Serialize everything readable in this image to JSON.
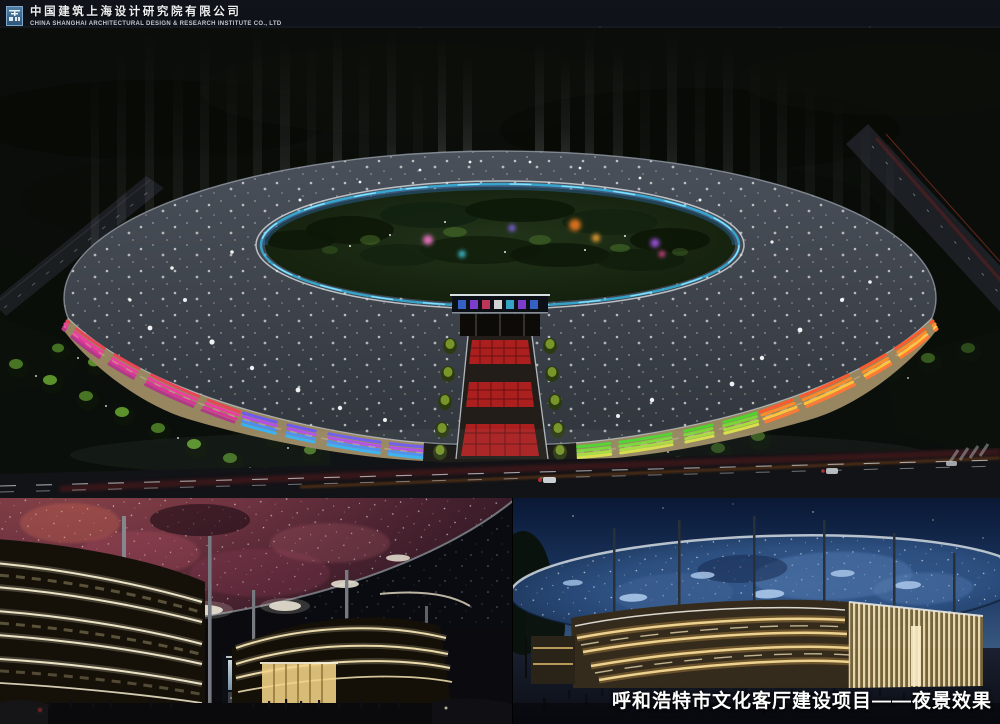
{
  "header": {
    "company_name_zh": "中国建筑上海设计研究院有限公司",
    "company_name_en": "CHINA SHANGHAI ARCHITECTURAL DESIGN & RESEARCH INSTITUTE CO., LTD"
  },
  "footer": {
    "caption": "呼和浩特市文化客厅建设项目——夜景效果"
  },
  "palette": {
    "night_sky": "#0b0e13",
    "deep_blue_sky": "#16325c",
    "roof_gray": "#3e434b",
    "facade_tan": "#97865f",
    "facade_red": "#ea4556",
    "facade_magenta": "#ee3fa0",
    "facade_purple": "#b44fe8",
    "facade_blue": "#38b2f2",
    "facade_green": "#4fd42e",
    "facade_yellow": "#ffc23a",
    "facade_orange": "#ff8c2a",
    "glass_ring_cyan": "#35b9e6",
    "pavement_red": "#b32020",
    "nebula_canopy_red": "#6e3340",
    "starry_canopy_blue": "#2c4f80",
    "band_gold": "#f4d894"
  }
}
